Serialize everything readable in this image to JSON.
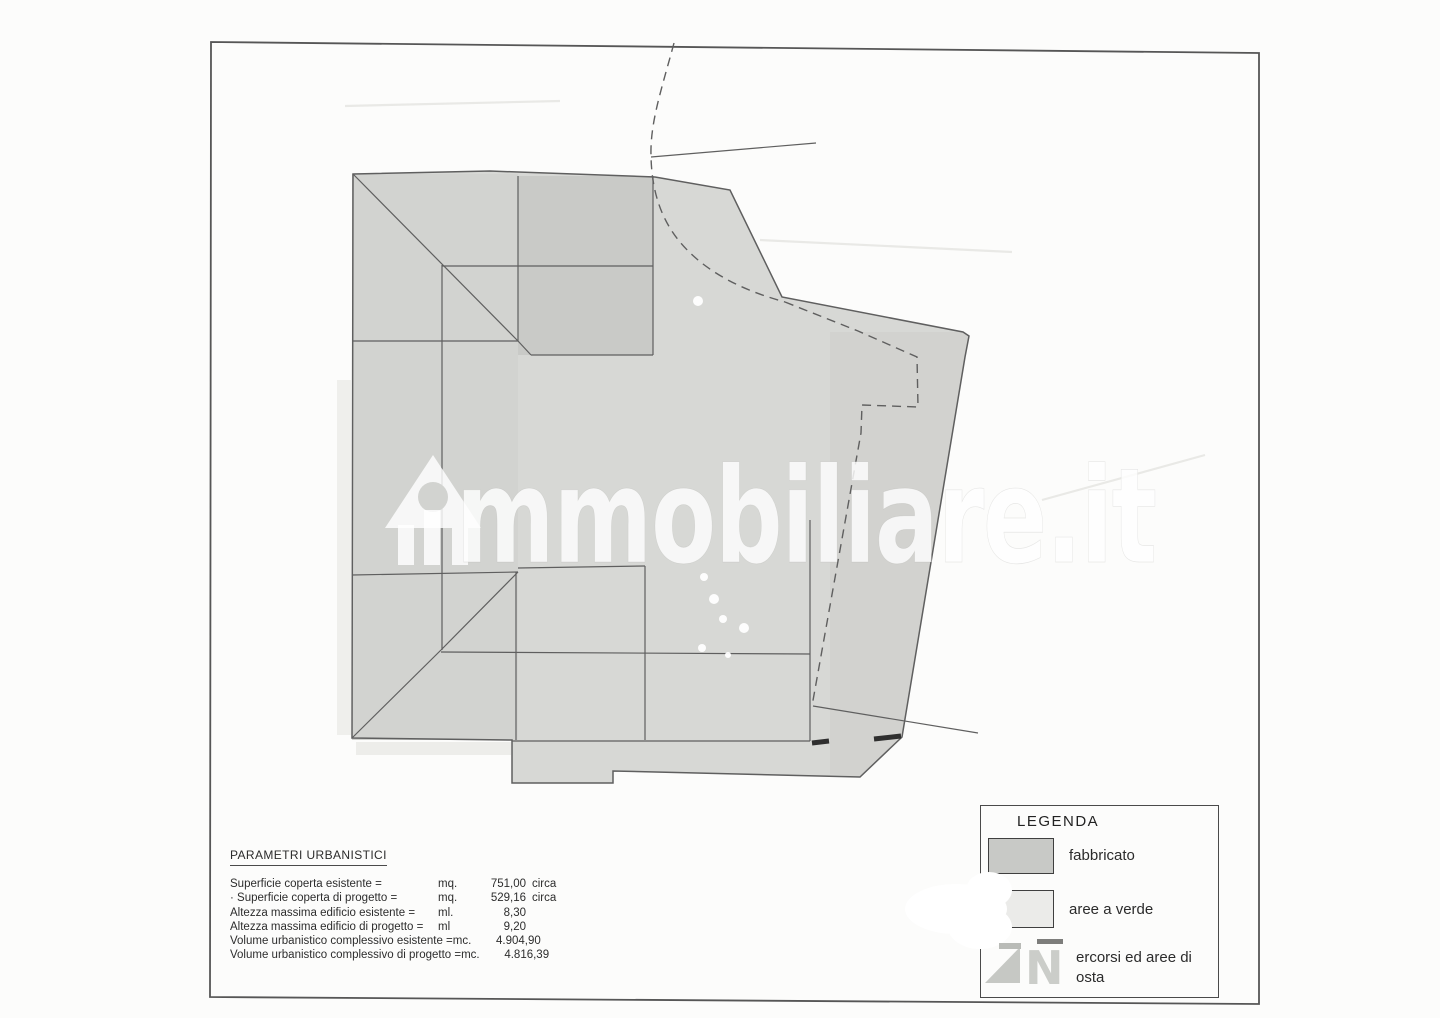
{
  "watermark": {
    "text": "mmobiliare.it",
    "icon": "house-icon"
  },
  "parameters": {
    "title": "PARAMETRI URBANISTICI",
    "rows": [
      {
        "label": "Superficie coperta esistente =",
        "unit": "mq.",
        "value": "751,00",
        "suffix": "circa"
      },
      {
        "label": "· Superficie coperta di progetto =",
        "unit": "mq.",
        "value": "529,16",
        "suffix": "circa"
      },
      {
        "label": "Altezza massima edificio esistente =",
        "unit": "ml.",
        "value": "8,30",
        "suffix": ""
      },
      {
        "label": "Altezza massima edificio di progetto =",
        "unit": "ml",
        "value": "9,20",
        "suffix": ""
      },
      {
        "label": "Volume urbanistico complessivo esistente =",
        "unit": "mc.",
        "value": "4.904,90",
        "suffix": ""
      },
      {
        "label": "Volume urbanistico complessivo di progetto =",
        "unit": "mc.",
        "value": "4.816,39",
        "suffix": ""
      }
    ]
  },
  "legend": {
    "title": "LEGENDA",
    "items": [
      {
        "label": "fabbricato"
      },
      {
        "label": "aree a verde"
      },
      {
        "label_line1": "ercorsi ed aree di",
        "label_line2": "osta"
      }
    ]
  },
  "colors": {
    "c-line": "#5f5f5f",
    "c-lot": "#d7d8d5",
    "c-bld": "#d2d3d0",
    "c-block": "#c9cac7",
    "c-band": "#cfd0cd",
    "c-wm": "#ffffff",
    "c-fabbricato": "#c8c9c6",
    "c-verde": "#ebebe9"
  }
}
